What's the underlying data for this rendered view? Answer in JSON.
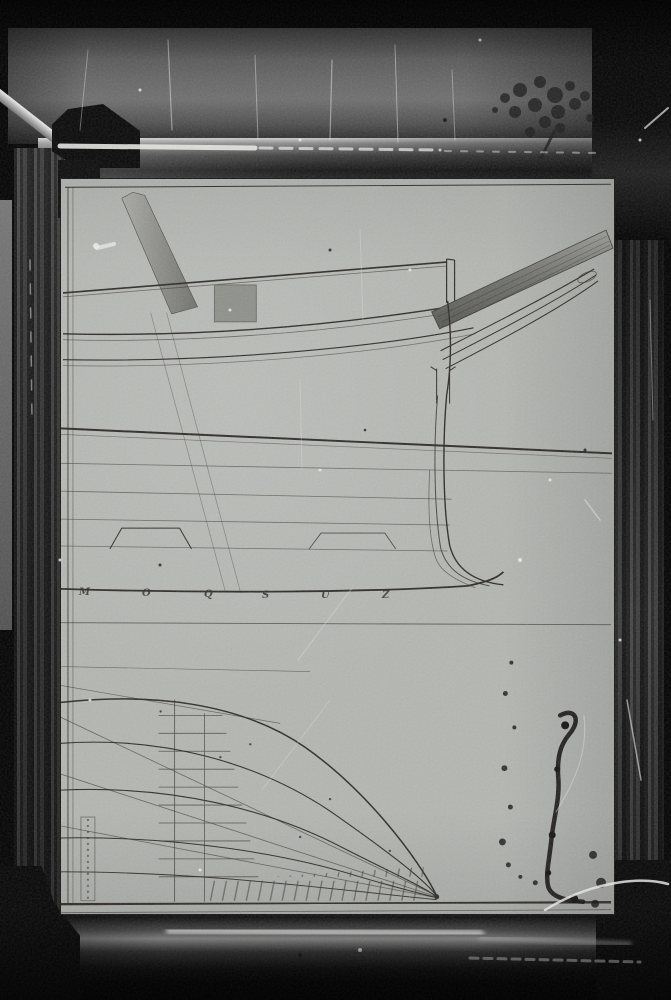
{
  "plan": {
    "station_labels": [
      "M",
      "O",
      "Q",
      "S",
      "U",
      "Z"
    ]
  },
  "colors": {
    "background": "#000000",
    "wall": "#666666",
    "sheet": "#b4b6b2",
    "ink": "#2e2b27",
    "frame_dark": "#181818",
    "frame_mid": "#3c3c3c",
    "highlight": "#e8e8e6",
    "patch": "#8e908a"
  }
}
